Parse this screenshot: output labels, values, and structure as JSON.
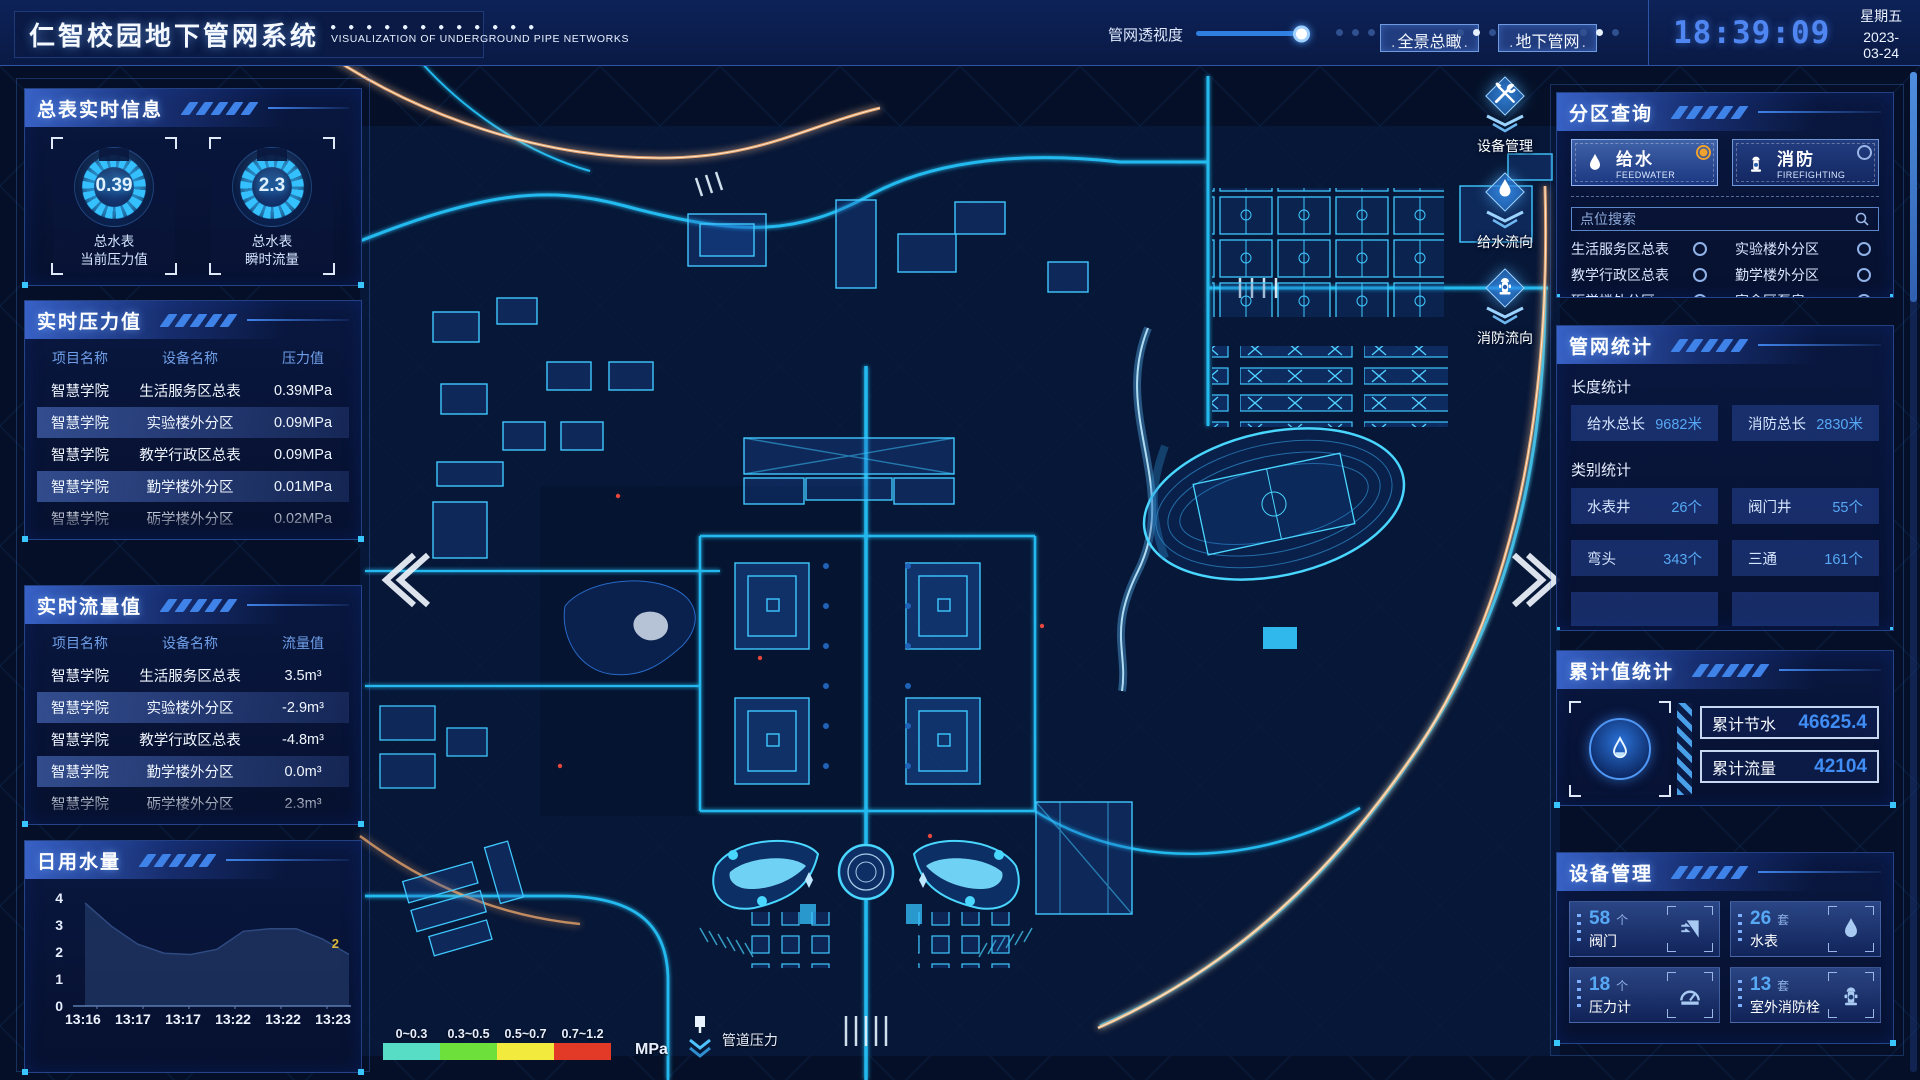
{
  "header": {
    "title": "仁智校园地下管网系统",
    "subtitle": "VISUALIZATION OF UNDERGROUND PIPE NETWORKS",
    "opacity_label": "管网透视度",
    "btn_overview": "全景总瞰",
    "btn_underground": "地下管网",
    "time": "18:39:09",
    "weekday": "星期五",
    "date": "2023-03-24"
  },
  "left": {
    "realtime_info": {
      "title": "总表实时信息",
      "gauges": [
        {
          "value": "0.39",
          "label1": "总水表",
          "label2": "当前压力值"
        },
        {
          "value": "2.3",
          "label1": "总水表",
          "label2": "瞬时流量"
        }
      ]
    },
    "pressure": {
      "title": "实时压力值",
      "headers": [
        "项目名称",
        "设备名称",
        "压力值"
      ],
      "rows": [
        {
          "project": "智慧学院",
          "device": "生活服务区总表",
          "value": "0.39MPa"
        },
        {
          "project": "智慧学院",
          "device": "实验楼外分区",
          "value": "0.09MPa"
        },
        {
          "project": "智慧学院",
          "device": "教学行政区总表",
          "value": "0.09MPa"
        },
        {
          "project": "智慧学院",
          "device": "勤学楼外分区",
          "value": "0.01MPa"
        },
        {
          "project": "智慧学院",
          "device": "砺学楼外分区",
          "value": "0.02MPa"
        }
      ]
    },
    "flow": {
      "title": "实时流量值",
      "headers": [
        "项目名称",
        "设备名称",
        "流量值"
      ],
      "rows": [
        {
          "project": "智慧学院",
          "device": "生活服务区总表",
          "value": "3.5m³"
        },
        {
          "project": "智慧学院",
          "device": "实验楼外分区",
          "value": "-2.9m³"
        },
        {
          "project": "智慧学院",
          "device": "教学行政区总表",
          "value": "-4.8m³"
        },
        {
          "project": "智慧学院",
          "device": "勤学楼外分区",
          "value": "0.0m³"
        },
        {
          "project": "智慧学院",
          "device": "砺学楼外分区",
          "value": "2.3m³"
        }
      ]
    },
    "daily_water": {
      "title": "日用水量",
      "type": "area",
      "y_ticks": [
        "4",
        "3",
        "2",
        "1",
        "0"
      ],
      "x_labels": [
        "13:16",
        "13:17",
        "13:17",
        "13:22",
        "13:22",
        "13:23"
      ],
      "values": [
        4,
        3.1,
        2.4,
        2.05,
        2.0,
        2.2,
        2.9,
        3.0,
        3.0,
        2.6,
        2.0
      ],
      "ylim": [
        0,
        4
      ],
      "end_label": "2"
    }
  },
  "map": {
    "tools": [
      {
        "label": "设备管理",
        "icon": "wrench-icon"
      },
      {
        "label": "给水流向",
        "icon": "water-drop-icon"
      },
      {
        "label": "消防流向",
        "icon": "hydrant-icon"
      }
    ],
    "legend": {
      "ranges": [
        "0~0.3",
        "0.3~0.5",
        "0.5~0.7",
        "0.7~1.2"
      ],
      "colors": [
        "#57dcc5",
        "#6ee03c",
        "#f2ea3c",
        "#e23a26"
      ],
      "unit": "MPa",
      "pipe_label": "管道压力"
    }
  },
  "right": {
    "zone_query": {
      "title": "分区查询",
      "feedwater": {
        "cn": "给水",
        "en": "FEEDWATER"
      },
      "firefighting": {
        "cn": "消防",
        "en": "FIREFIGHTING"
      },
      "search_placeholder": "点位搜索",
      "options": [
        "生活服务区总表",
        "实验楼外分区",
        "教学行政区总表",
        "勤学楼外分区",
        "砺学楼外分区",
        "宿舍区泵房"
      ]
    },
    "pipe_stats": {
      "title": "管网统计",
      "length_label": "长度统计",
      "length_items": [
        {
          "label": "给水总长",
          "value": "9682米"
        },
        {
          "label": "消防总长",
          "value": "2830米"
        }
      ],
      "category_label": "类别统计",
      "category_items": [
        {
          "label": "水表井",
          "value": "26个"
        },
        {
          "label": "阀门井",
          "value": "55个"
        },
        {
          "label": "弯头",
          "value": "343个"
        },
        {
          "label": "三通",
          "value": "161个"
        }
      ]
    },
    "cumulative": {
      "title": "累计值统计",
      "items": [
        {
          "label": "累计节水",
          "value": "46625.4"
        },
        {
          "label": "累计流量",
          "value": "42104"
        }
      ]
    },
    "devices": {
      "title": "设备管理",
      "cards": [
        {
          "count": "58",
          "unit": "个",
          "label": "阀门",
          "icon": "valve-icon"
        },
        {
          "count": "26",
          "unit": "套",
          "label": "水表",
          "icon": "water-drop-icon"
        },
        {
          "count": "18",
          "unit": "个",
          "label": "压力计",
          "icon": "pressure-gauge-icon"
        },
        {
          "count": "13",
          "unit": "套",
          "label": "室外消防栓",
          "icon": "hydrant-icon"
        }
      ]
    }
  }
}
